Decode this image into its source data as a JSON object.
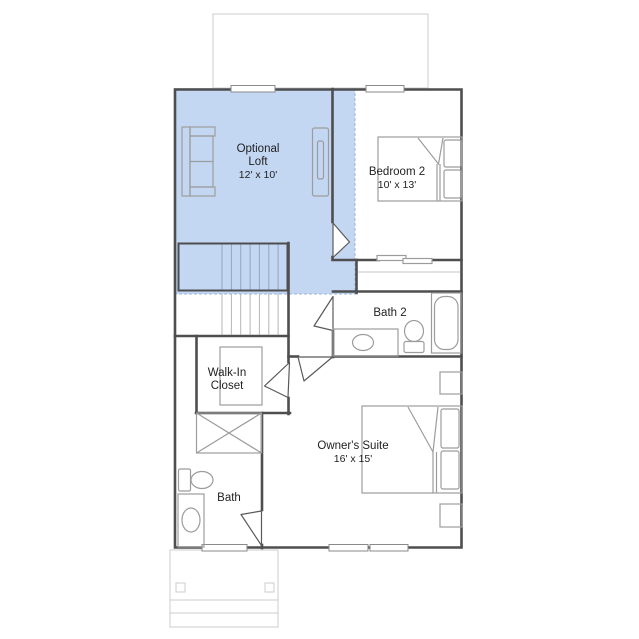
{
  "plan_title": "second-floor-plan",
  "rooms": {
    "loft": {
      "name_line1": "Optional",
      "name_line2": "Loft",
      "dims": "12' x 10'"
    },
    "bedroom2": {
      "name": "Bedroom 2",
      "dims": "10' x 13'"
    },
    "bath2": {
      "name": "Bath 2"
    },
    "walk_in_closet": {
      "name_line1": "Walk-In",
      "name_line2": "Closet"
    },
    "owners_suite": {
      "name": "Owner's Suite",
      "dims": "16' x 15'"
    },
    "bath": {
      "name": "Bath"
    }
  },
  "colors": {
    "loft_highlight": "#c3d7f3",
    "wall": "#4e4e4e",
    "fixture": "#9c9c9c",
    "faint_outline": "#cccccc",
    "label_text": "#222222"
  }
}
